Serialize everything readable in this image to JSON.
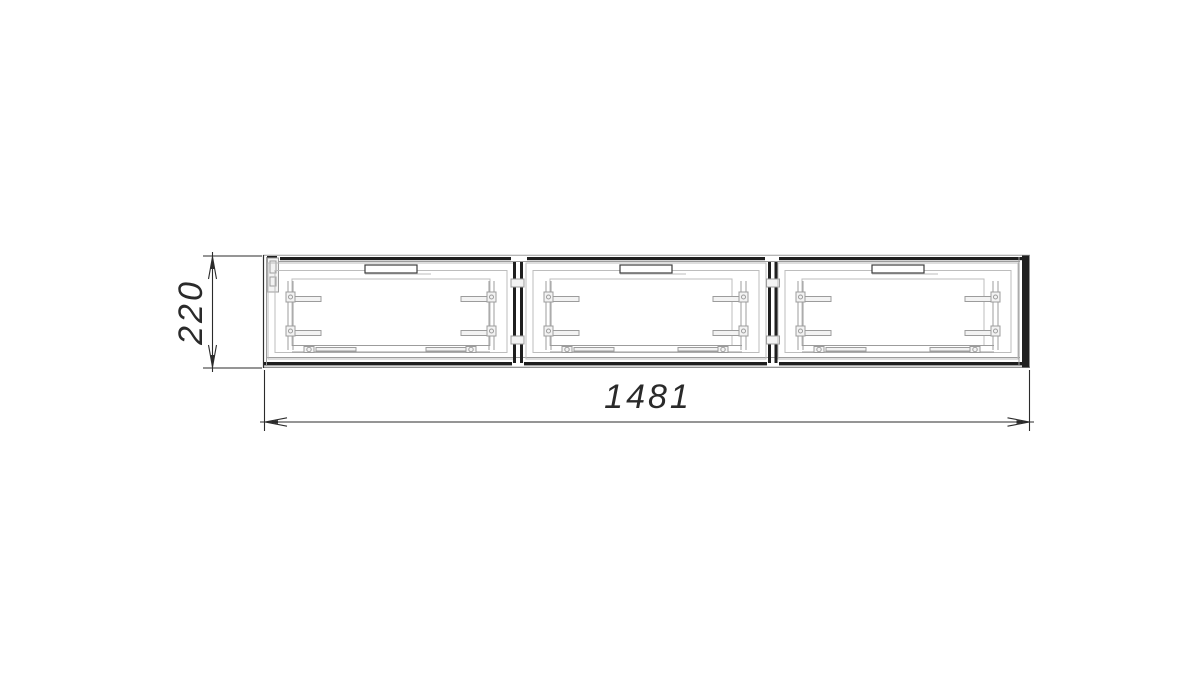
{
  "drawing": {
    "kind": "technical-drawing-front-view",
    "structure": {
      "section_count": 3
    },
    "dimensions": {
      "width": {
        "label": "1481"
      },
      "height": {
        "label": "220"
      }
    }
  },
  "colors": {
    "background": "#ffffff",
    "outline_dark": "#1f1f1f",
    "detail_gray": "#9c9c9c",
    "detail_light": "#bdbdbd",
    "dimension_text": "#2a2a2a"
  }
}
